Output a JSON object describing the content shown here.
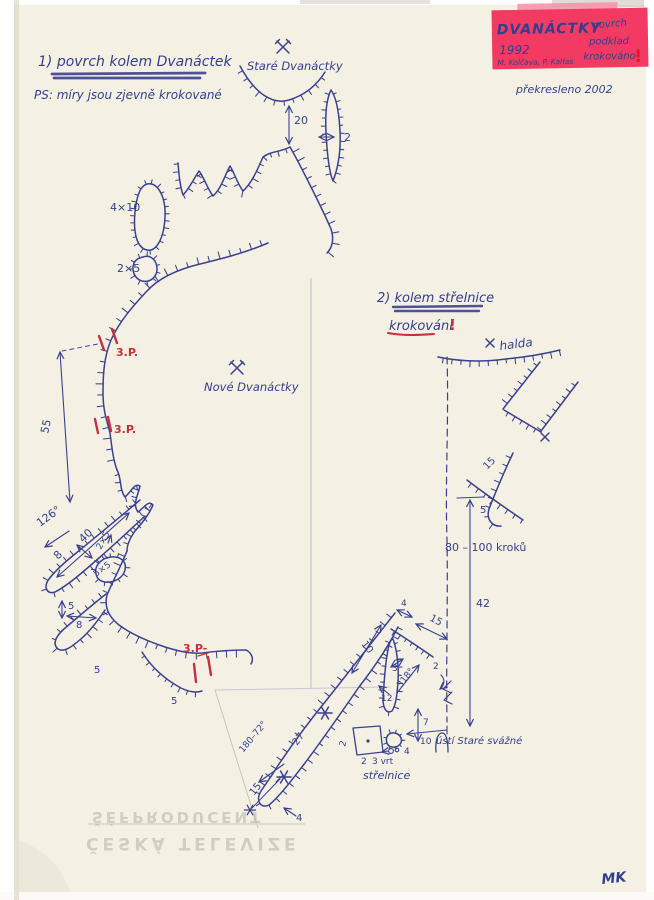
{
  "document": {
    "section1": {
      "heading": "1) povrch kolem Dvanáctek",
      "note": "PS: míry jsou zjevně krokované"
    },
    "section2": {
      "heading": "2) kolem střelnice",
      "subheading": "krokování",
      "exclamation": "!"
    },
    "sticky_note": {
      "title": "DVANÁCTKY",
      "year": "1992",
      "word1": "povrch",
      "word2": "podklad",
      "word3": "krokováno",
      "exclamation": "!",
      "authors": "M. Kolčava, P. Kalfas",
      "bg_color": "#f23a63",
      "text_color": "#9b1126"
    },
    "redrawn_note": "překresleno 2002",
    "signature": "MK"
  },
  "map": {
    "site_labels": {
      "old_mine": "Staré Dvanáctky",
      "new_mine": "Nové Dvanáctky",
      "heap": "halda",
      "shooting_range": "střelnice",
      "adit": "ústí Staré svážné"
    },
    "icons": {
      "crossed_hammers": "mine-symbol",
      "star": "survey-station-mark",
      "x": "point-mark"
    },
    "colors": {
      "ink": "#3a418f",
      "red": "#c5303c",
      "paper": "#f4f0e3",
      "note_pink": "#f23a63"
    },
    "annotations": [
      {
        "t": "20",
        "x": 294,
        "y": 124
      },
      {
        "t": "2",
        "x": 344,
        "y": 141
      },
      {
        "t": "4×10",
        "x": 110,
        "y": 211
      },
      {
        "t": "2×5",
        "x": 117,
        "y": 272
      },
      {
        "t": "55",
        "x": 48,
        "y": 434,
        "r": -78
      },
      {
        "t": "126°",
        "x": 40,
        "y": 527,
        "r": -36
      },
      {
        "t": "40",
        "x": 83,
        "y": 543,
        "r": -43
      },
      {
        "t": "8",
        "x": 58,
        "y": 560,
        "r": -45
      },
      {
        "t": "2×5",
        "x": 101,
        "y": 550,
        "r": -62,
        "s": 9
      },
      {
        "t": "5×5",
        "x": 96,
        "y": 577,
        "r": -36,
        "s": 9
      },
      {
        "t": "5",
        "x": 68,
        "y": 609,
        "s": 10
      },
      {
        "t": "8",
        "x": 76,
        "y": 628,
        "s": 10
      },
      {
        "t": "5",
        "x": 94,
        "y": 673,
        "s": 10
      },
      {
        "t": "5",
        "x": 171,
        "y": 704,
        "s": 10
      },
      {
        "t": "3.P.",
        "x": 116,
        "y": 356,
        "c": "red"
      },
      {
        "t": "3.P.",
        "x": 114,
        "y": 433,
        "c": "red"
      },
      {
        "t": "3.P-",
        "x": 183,
        "y": 652,
        "c": "red"
      },
      {
        "t": "15",
        "x": 487,
        "y": 470,
        "r": -45,
        "s": 10
      },
      {
        "t": "5",
        "x": 480,
        "y": 513,
        "s": 10
      },
      {
        "t": "80 – 100 kroků",
        "x": 445,
        "y": 551
      },
      {
        "t": "42",
        "x": 476,
        "y": 607
      },
      {
        "t": "4",
        "x": 401,
        "y": 606,
        "s": 9
      },
      {
        "t": "15",
        "x": 429,
        "y": 620,
        "r": 28,
        "s": 10
      },
      {
        "t": "10",
        "x": 361,
        "y": 644,
        "r": 52,
        "s": 10
      },
      {
        "t": "3",
        "x": 392,
        "y": 671,
        "s": 9
      },
      {
        "t": "318°",
        "x": 401,
        "y": 688,
        "r": -52,
        "s": 9
      },
      {
        "t": "2",
        "x": 433,
        "y": 669,
        "s": 9
      },
      {
        "t": "12",
        "x": 381,
        "y": 701,
        "s": 9
      },
      {
        "t": "7",
        "x": 423,
        "y": 725,
        "s": 9
      },
      {
        "t": "10",
        "x": 420,
        "y": 744,
        "s": 9
      },
      {
        "t": "4",
        "x": 404,
        "y": 754,
        "s": 9
      },
      {
        "t": "2",
        "x": 345,
        "y": 747,
        "r": -75,
        "s": 9
      },
      {
        "t": "2",
        "x": 361,
        "y": 764,
        "s": 9
      },
      {
        "t": "3 vrt",
        "x": 372,
        "y": 764,
        "s": 9
      },
      {
        "t": "27",
        "x": 297,
        "y": 746,
        "r": -53,
        "s": 10
      },
      {
        "t": "180–72°",
        "x": 243,
        "y": 753,
        "r": -50,
        "s": 9
      },
      {
        "t": "15",
        "x": 254,
        "y": 796,
        "r": -52,
        "s": 10
      },
      {
        "t": "4",
        "x": 296,
        "y": 821,
        "s": 10
      }
    ]
  },
  "watermark": {
    "line1": "ŠÉFPRODUCENT",
    "line2": "ČESKÁ TELEVIZE"
  }
}
